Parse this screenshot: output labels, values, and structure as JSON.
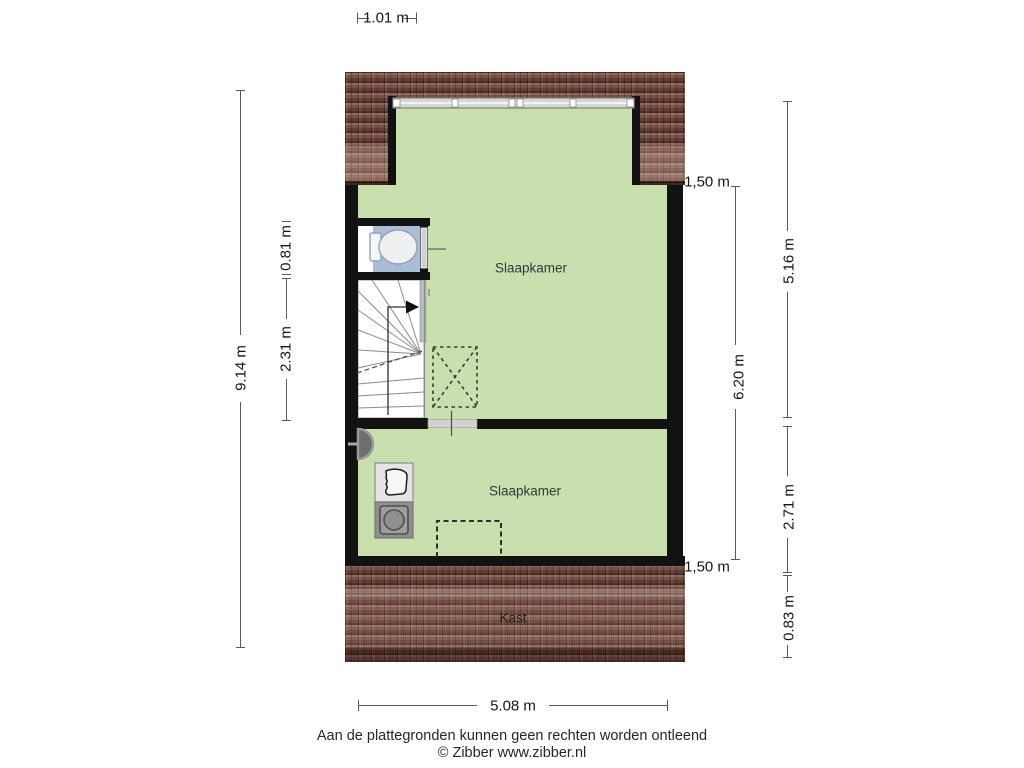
{
  "plan": {
    "rooms": {
      "bedroom_upper": "Slaapkamer",
      "bedroom_lower": "Slaapkamer",
      "closet": "Kast"
    },
    "dimensions": {
      "top_width": "1.01 m",
      "total_height_left": "9.14 m",
      "toilet_height": "0.81 m",
      "stair_height": "2.31 m",
      "offset_top_right": "1,50 m",
      "dormer_height_right": "5.16 m",
      "interior_height_right": "6.20 m",
      "lower_room_height_right": "2.71 m",
      "offset_bottom_right": "1,50 m",
      "roof_bottom_height": "0.83 m",
      "bottom_width": "5.08 m"
    },
    "footer": {
      "disclaimer": "Aan de plattegronden kunnen geen rechten worden ontleend",
      "credit": "© Zibber www.zibber.nl"
    },
    "icons": {
      "toilet": "toilet-icon",
      "sink": "sink-icon",
      "washing_machine": "washing-machine-icon",
      "stairs": "stairs-icon",
      "vent": "vent-icon",
      "roof_window": "roof-window-dashed-icon",
      "dormer_outline": "dormer-dashed-icon"
    },
    "colors": {
      "floor_green": "#cadfae",
      "roof_brown": "#7b5044",
      "toilet_blue": "#a9bed6",
      "wall_black": "#121212",
      "dimension_line": "#555555"
    }
  }
}
